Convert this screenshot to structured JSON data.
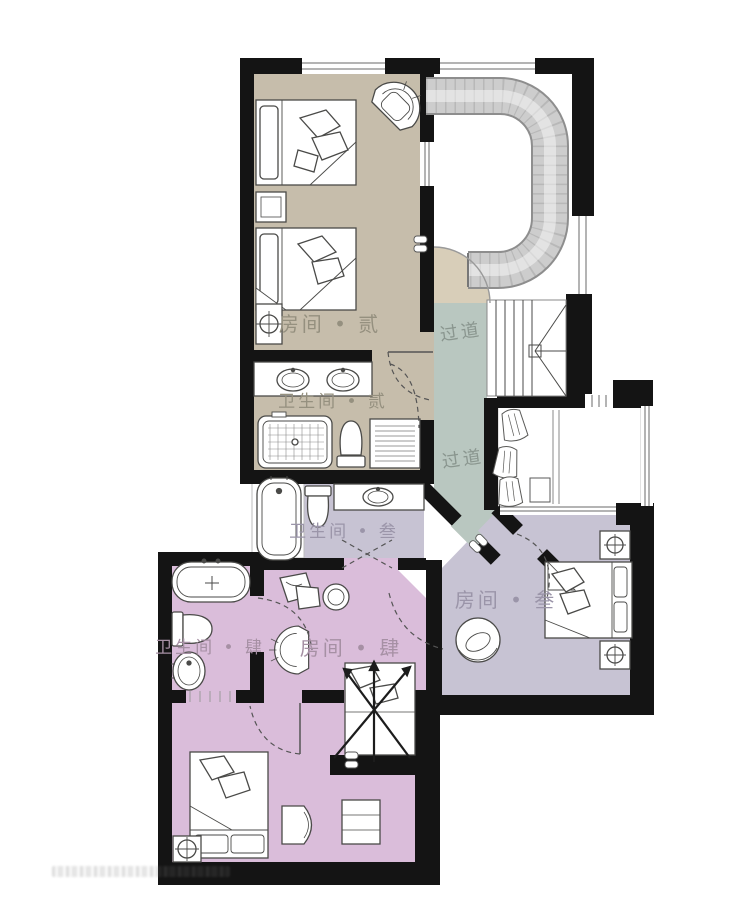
{
  "plan": {
    "rooms": {
      "room2": {
        "label": "房间 • 贰",
        "color": "#c6bdab",
        "label_color": "#95907f"
      },
      "bath2": {
        "label": "卫生间 • 贰",
        "color": "#c6bdab",
        "label_color": "#95907f"
      },
      "hall_upper": {
        "label": "过道",
        "color": "#b9c7c0",
        "label_color": "#8a968f"
      },
      "hall_lower": {
        "label": "过道"
      },
      "bath3": {
        "label": "卫生间 • 叁",
        "color": "#c7c3d3",
        "label_color": "#9b95a9"
      },
      "room3": {
        "label": "房间 • 叁",
        "color": "#c7c3d3",
        "label_color": "#9b95a9"
      },
      "bath4": {
        "label": "卫生间 • 肆",
        "color": "#dabdda",
        "label_color": "#a690a4"
      },
      "room4": {
        "label": "房间 • 肆",
        "color": "#dabdda",
        "label_color": "#a690a4"
      }
    },
    "landing_color": "#d8ceb9",
    "wall_color": "#141414"
  }
}
